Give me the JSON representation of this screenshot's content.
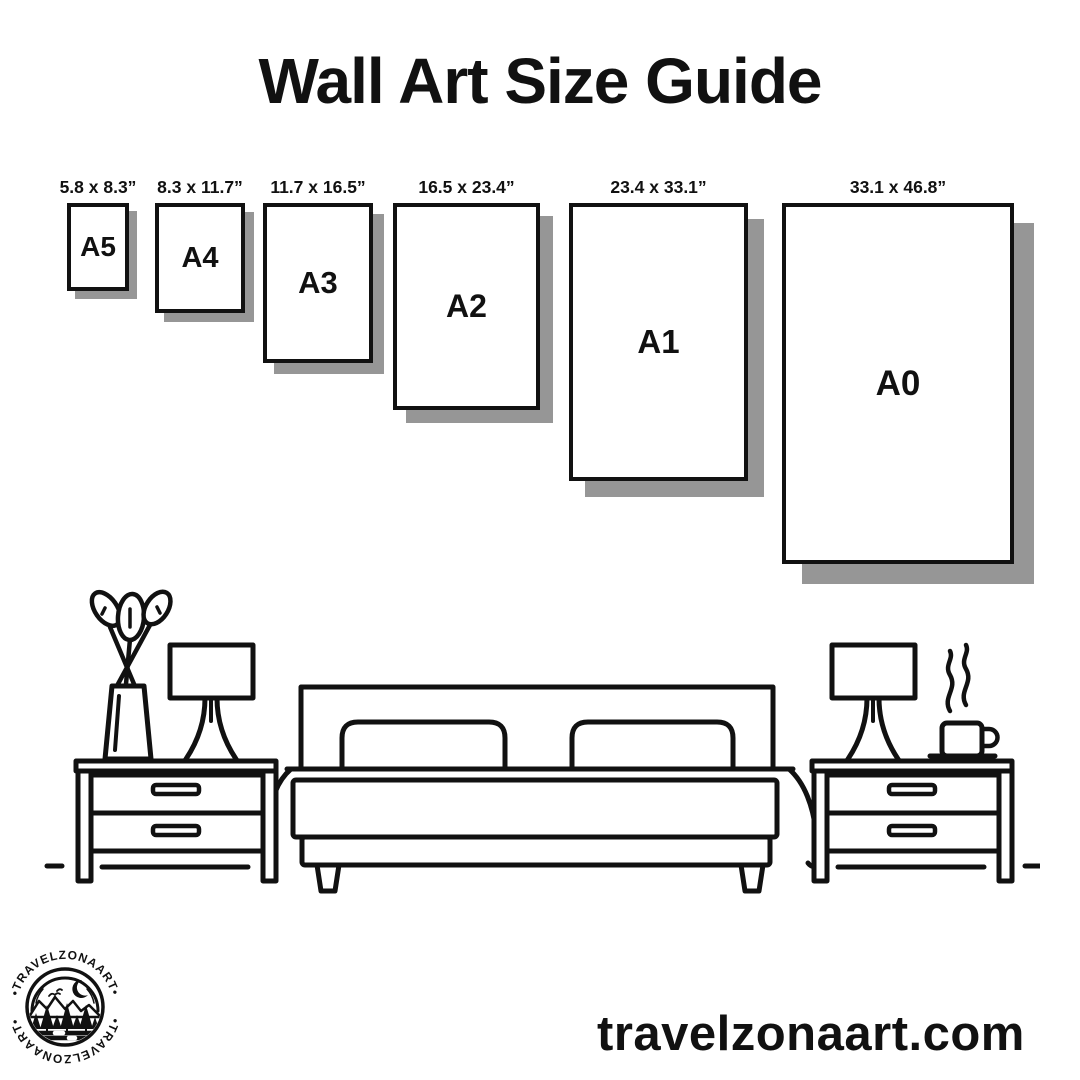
{
  "title": "Wall Art Size Guide",
  "sizes": [
    {
      "id": "a5",
      "name": "A5",
      "dims": "5.8 x 8.3”"
    },
    {
      "id": "a4",
      "name": "A4",
      "dims": "8.3 x 11.7”"
    },
    {
      "id": "a3",
      "name": "A3",
      "dims": "11.7 x 16.5”"
    },
    {
      "id": "a2",
      "name": "A2",
      "dims": "16.5 x 23.4”"
    },
    {
      "id": "a1",
      "name": "A1",
      "dims": "23.4 x 33.1”"
    },
    {
      "id": "a0",
      "name": "A0",
      "dims": "33.1 x 46.8”"
    }
  ],
  "scene": {
    "icons": [
      "potted-plant",
      "table-lamp",
      "double-bed",
      "nightstand",
      "coffee-cup"
    ]
  },
  "logo": {
    "brand": "TRAVELZONAART",
    "arc_text": "•TRAVELZONAART•"
  },
  "footer": {
    "website": "travelzonaart.com"
  },
  "colors": {
    "ink": "#111111",
    "shadow": "#969696",
    "background": "#ffffff"
  }
}
